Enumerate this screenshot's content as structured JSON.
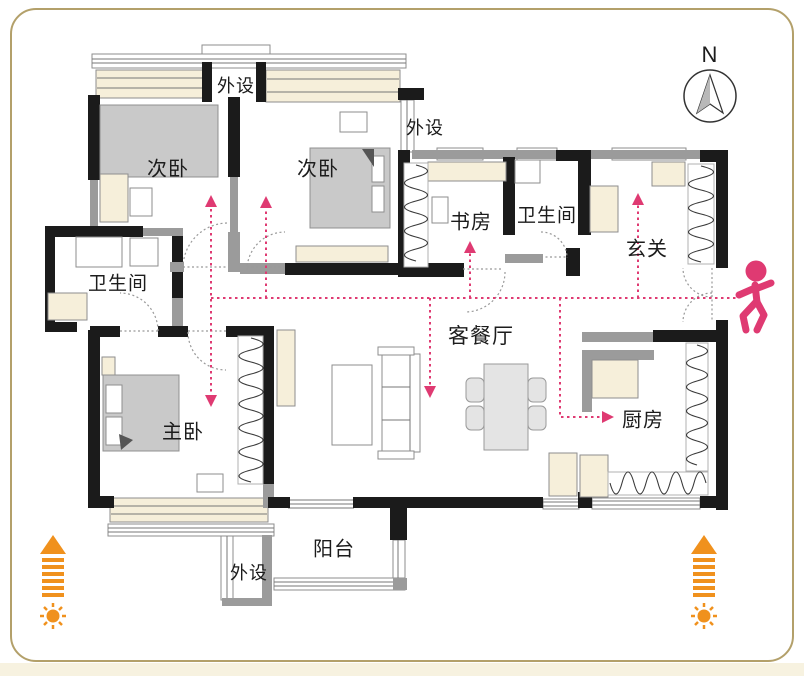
{
  "colors": {
    "accent_pink": "#df3a72",
    "accent_orange": "#f0911d",
    "wall_black": "#1b1b1b",
    "partition_gray": "#9b9b9b",
    "window_cream": "#f6efda",
    "furniture_gray": "#c9c9c9",
    "frame_border": "#b3a06a"
  },
  "compass": {
    "label": "N"
  },
  "rooms": [
    {
      "id": "utility-top",
      "label": "外设"
    },
    {
      "id": "bedroom-left",
      "label": "次卧"
    },
    {
      "id": "bedroom-middle",
      "label": "次卧"
    },
    {
      "id": "utility-right",
      "label": "外设"
    },
    {
      "id": "study",
      "label": "书房"
    },
    {
      "id": "bathroom-top",
      "label": "卫生间"
    },
    {
      "id": "entry",
      "label": "玄关"
    },
    {
      "id": "bathroom-left",
      "label": "卫生间"
    },
    {
      "id": "living-dining",
      "label": "客餐厅"
    },
    {
      "id": "master-bedroom",
      "label": "主卧"
    },
    {
      "id": "kitchen",
      "label": "厨房"
    },
    {
      "id": "balcony",
      "label": "阳台"
    },
    {
      "id": "utility-bottom",
      "label": "外设"
    }
  ]
}
